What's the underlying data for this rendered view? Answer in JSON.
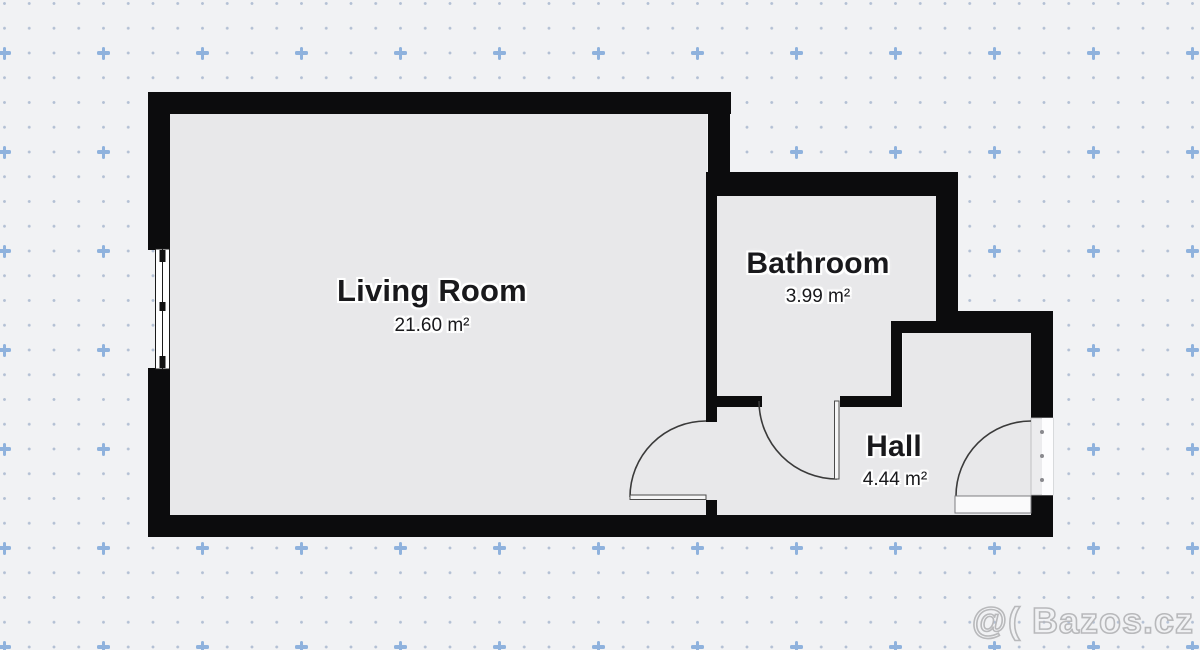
{
  "plan": {
    "rooms": [
      {
        "name": "Living Room",
        "area": "21.60 m²"
      },
      {
        "name": "Bathroom",
        "area": "3.99 m²"
      },
      {
        "name": "Hall",
        "area": "4.44 m²"
      }
    ]
  },
  "watermark": {
    "text": "@( Bazos.cz"
  },
  "colors": {
    "bg": "#f1f2f4",
    "floor": "#e8e8ea",
    "wall": "#0c0c0d",
    "dot": "#b3c0d4",
    "plus": "#8fb2dd",
    "ink": "#19191c",
    "wm": "#b6b6b9",
    "line": "#3a3a3a",
    "halo": "#ffffff"
  }
}
